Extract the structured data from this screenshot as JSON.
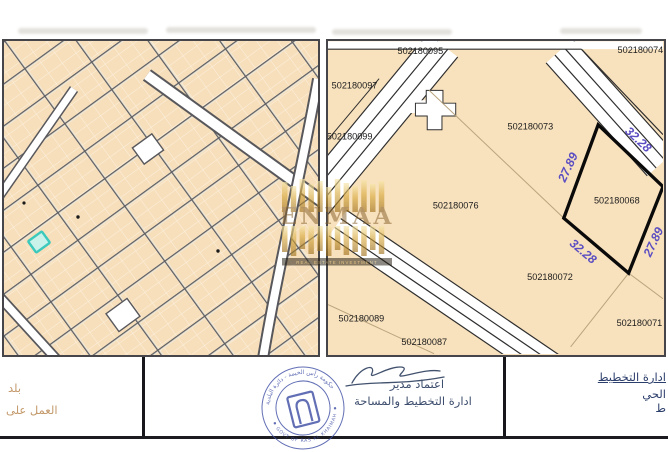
{
  "watermark": {
    "brand": "ENMAA",
    "tagline": "REAL ESTATE INVESTMENT"
  },
  "right_map": {
    "plots": [
      {
        "id": "502180095"
      },
      {
        "id": "502180097"
      },
      {
        "id": "502180099"
      },
      {
        "id": "502180073"
      },
      {
        "id": "502180074"
      },
      {
        "id": "502180076"
      },
      {
        "id": "502180072"
      },
      {
        "id": "502180089"
      },
      {
        "id": "502180087"
      },
      {
        "id": "502180071"
      }
    ],
    "selected_plot": {
      "id": "502180068",
      "dimensions": {
        "top_left": "27.89",
        "top_right": "32.28",
        "bottom_left": "32.28",
        "bottom_right": "27.89"
      }
    }
  },
  "footer": {
    "left": {
      "line1": "بلد",
      "line2": "العمل على"
    },
    "center": {
      "approval": "اعتماد مدير",
      "department": "ادارة التخطيط والمساحة"
    },
    "right": {
      "line1": "ادارة التخطيط",
      "line2": "الحي",
      "line3": "ط"
    },
    "stamp": {
      "arabic_text": "حكومة رأس الخيمة - دائرة البلدية",
      "english_text": "GOVT OF RAS AL KHAIMAH"
    }
  },
  "colors": {
    "parcel_tan": "#f7dfbb",
    "street_gray": "#5d5d62",
    "highlight_teal": "#3cc9bd",
    "dimension_purple": "#5b4ec2",
    "selected_plot_border": "#0a0a0a",
    "stamp_blue": "#4050a5",
    "watermark_gold": "#c9952c"
  }
}
